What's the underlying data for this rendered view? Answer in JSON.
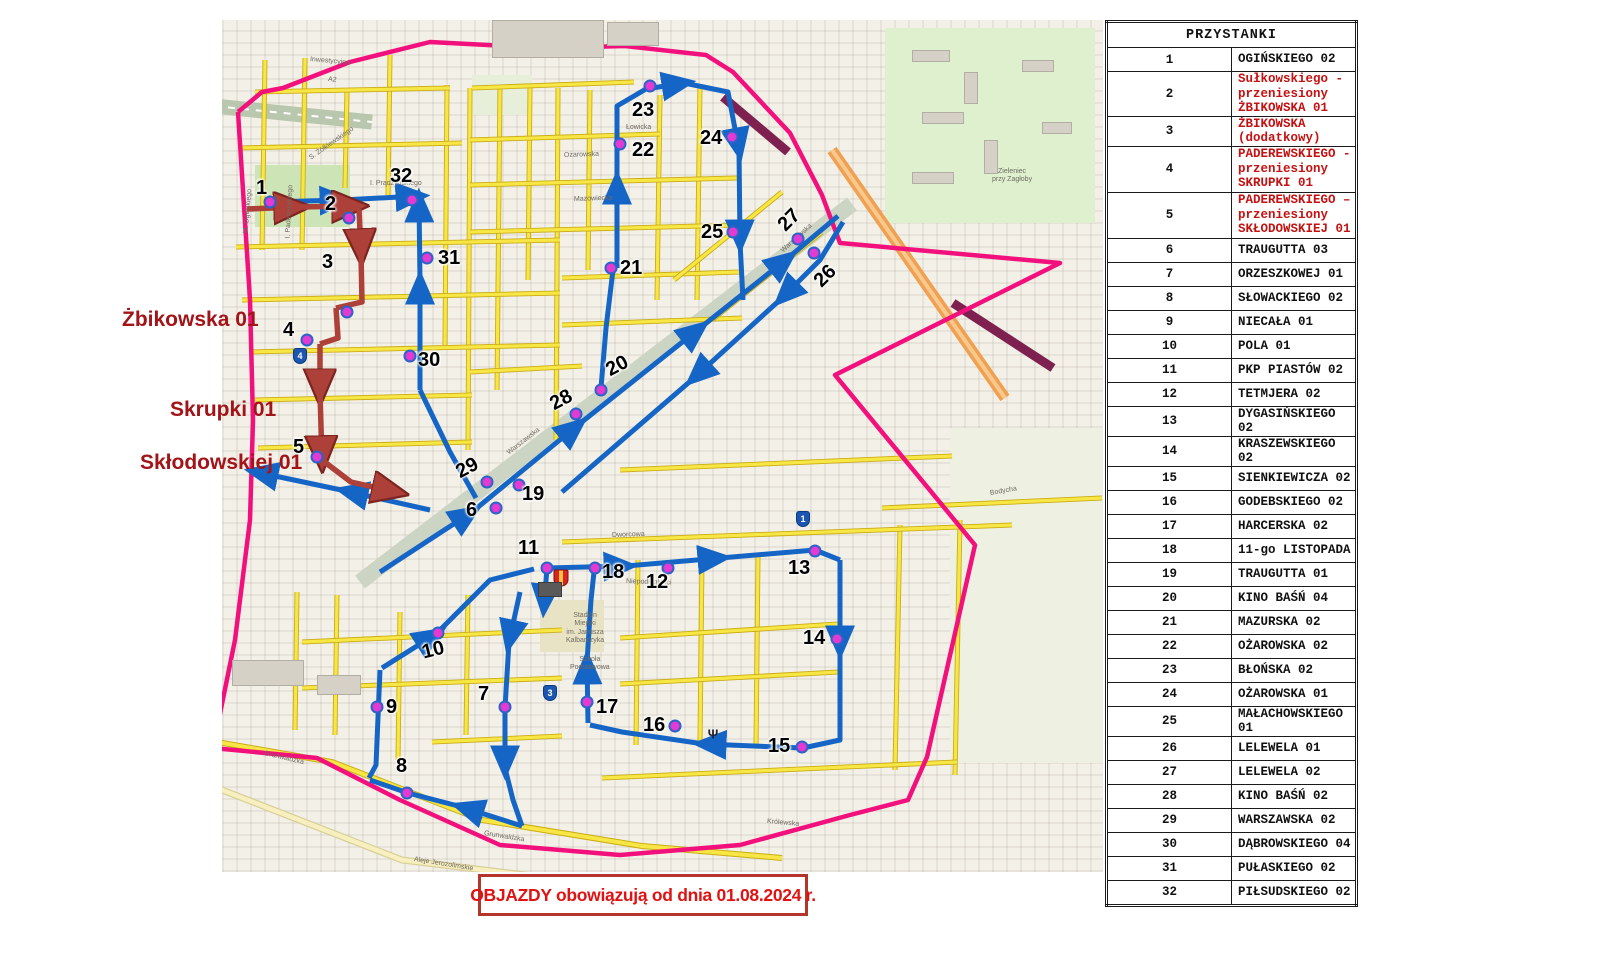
{
  "banner": {
    "text": "OBJAZDY obowiązują od dnia 01.08.2024 r."
  },
  "legend": {
    "items": [
      {
        "icon": "stop-dot-icon",
        "label": "- przystanki"
      },
      {
        "icon": "blue-route-arrow-icon",
        "label": "- trasa i kierunek jazdy"
      },
      {
        "icon": "detour-arrow-icon",
        "label": "- Objazd: zamknięcie",
        "label2": "ul. Ogińskiego"
      }
    ]
  },
  "left_labels": [
    {
      "text": "Żbikowska 01",
      "x": 122,
      "y": 308
    },
    {
      "text": "Skrupki 01",
      "x": 170,
      "y": 398
    },
    {
      "text": "Skłodowskiej 01",
      "x": 140,
      "y": 451
    }
  ],
  "table": {
    "header": "PRZYSTANKI",
    "rows": [
      {
        "no": 1,
        "lines": [
          "OGIŃSKIEGO 02"
        ],
        "red": false
      },
      {
        "no": 2,
        "lines": [
          "Sułkowskiego - przeniesiony",
          "ŻBIKOWSKA 01"
        ],
        "red": true
      },
      {
        "no": 3,
        "lines": [
          "ŻBIKOWSKA (dodatkowy)"
        ],
        "red": true
      },
      {
        "no": 4,
        "lines": [
          "PADEREWSKIEGO -",
          "przeniesiony",
          "SKRUPKI 01"
        ],
        "red": true
      },
      {
        "no": 5,
        "lines": [
          "PADEREWSKIEGO –",
          "przeniesiony",
          "SKŁODOWSKIEJ 01"
        ],
        "red": true
      },
      {
        "no": 6,
        "lines": [
          "TRAUGUTTA 03"
        ],
        "red": false
      },
      {
        "no": 7,
        "lines": [
          "ORZESZKOWEJ 01"
        ],
        "red": false
      },
      {
        "no": 8,
        "lines": [
          "SŁOWACKIEGO 02"
        ],
        "red": false
      },
      {
        "no": 9,
        "lines": [
          "NIECAŁA 01"
        ],
        "red": false
      },
      {
        "no": 10,
        "lines": [
          "POLA 01"
        ],
        "red": false
      },
      {
        "no": 11,
        "lines": [
          "PKP PIASTÓW 02"
        ],
        "red": false
      },
      {
        "no": 12,
        "lines": [
          "TETMJERA 02"
        ],
        "red": false
      },
      {
        "no": 13,
        "lines": [
          "DYGASIŃSKIEGO 02"
        ],
        "red": false
      },
      {
        "no": 14,
        "lines": [
          "KRASZEWSKIEGO 02"
        ],
        "red": false
      },
      {
        "no": 15,
        "lines": [
          "SIENKIEWICZA 02"
        ],
        "red": false
      },
      {
        "no": 16,
        "lines": [
          "GODEBSKIEGO 02"
        ],
        "red": false
      },
      {
        "no": 17,
        "lines": [
          "HARCERSKA 02"
        ],
        "red": false
      },
      {
        "no": 18,
        "lines": [
          "11-go LISTOPADA"
        ],
        "red": false
      },
      {
        "no": 19,
        "lines": [
          "TRAUGUTTA 01"
        ],
        "red": false
      },
      {
        "no": 20,
        "lines": [
          "KINO BAŚŃ  04"
        ],
        "red": false
      },
      {
        "no": 21,
        "lines": [
          "MAZURSKA 02"
        ],
        "red": false
      },
      {
        "no": 22,
        "lines": [
          "OŻAROWSKA 02"
        ],
        "red": false
      },
      {
        "no": 23,
        "lines": [
          "BŁOŃSKA 02"
        ],
        "red": false
      },
      {
        "no": 24,
        "lines": [
          "OŻAROWSKA 01"
        ],
        "red": false
      },
      {
        "no": 25,
        "lines": [
          "MAŁACHOWSKIEGO 01"
        ],
        "red": false
      },
      {
        "no": 26,
        "lines": [
          "LELEWELA  01"
        ],
        "red": false
      },
      {
        "no": 27,
        "lines": [
          "LELEWELA  02"
        ],
        "red": false
      },
      {
        "no": 28,
        "lines": [
          "KINO BAŚŃ 02"
        ],
        "red": false
      },
      {
        "no": 29,
        "lines": [
          "WARSZAWSKA 02"
        ],
        "red": false
      },
      {
        "no": 30,
        "lines": [
          "DĄBROWSKIEGO 04"
        ],
        "red": false
      },
      {
        "no": 31,
        "lines": [
          "PUŁASKIEGO 02"
        ],
        "red": false
      },
      {
        "no": 32,
        "lines": [
          "PIŁSUDSKIEGO 02"
        ],
        "red": false
      }
    ]
  },
  "map": {
    "stops": [
      {
        "no": "1",
        "dot": [
          48,
          182
        ],
        "label": [
          34,
          158
        ]
      },
      {
        "no": "2",
        "dot": [
          127,
          198
        ],
        "label": [
          103,
          174
        ]
      },
      {
        "no": "3",
        "dot": [
          125,
          292
        ],
        "label": [
          100,
          232
        ]
      },
      {
        "no": "4",
        "dot": [
          85,
          320
        ],
        "label": [
          61,
          300
        ]
      },
      {
        "no": "5",
        "dot": [
          95,
          437
        ],
        "label": [
          71,
          417
        ]
      },
      {
        "no": "6",
        "dot": [
          274,
          488
        ],
        "label": [
          244,
          480
        ]
      },
      {
        "no": "7",
        "dot": [
          283,
          687
        ],
        "label": [
          256,
          664
        ]
      },
      {
        "no": "8",
        "dot": [
          185,
          773
        ],
        "label": [
          174,
          736
        ]
      },
      {
        "no": "9",
        "dot": [
          155,
          687
        ],
        "label": [
          164,
          677
        ]
      },
      {
        "no": "10",
        "dot": [
          216,
          613
        ],
        "label": [
          200,
          620
        ],
        "rot": -14
      },
      {
        "no": "11",
        "dot": [
          325,
          548
        ],
        "label": [
          296,
          518
        ]
      },
      {
        "no": "12",
        "dot": [
          446,
          548
        ],
        "label": [
          424,
          552
        ]
      },
      {
        "no": "13",
        "dot": [
          593,
          531
        ],
        "label": [
          566,
          538
        ]
      },
      {
        "no": "14",
        "dot": [
          615,
          619
        ],
        "label": [
          581,
          608
        ]
      },
      {
        "no": "15",
        "dot": [
          580,
          727
        ],
        "label": [
          546,
          716
        ]
      },
      {
        "no": "16",
        "dot": [
          453,
          706
        ],
        "label": [
          421,
          695
        ]
      },
      {
        "no": "17",
        "dot": [
          365,
          682
        ],
        "label": [
          374,
          677
        ]
      },
      {
        "no": "18",
        "dot": [
          373,
          548
        ],
        "label": [
          380,
          542
        ]
      },
      {
        "no": "19",
        "dot": [
          297,
          465
        ],
        "label": [
          300,
          464
        ]
      },
      {
        "no": "20",
        "dot": [
          379,
          370
        ],
        "label": [
          384,
          336
        ],
        "rot": -28
      },
      {
        "no": "21",
        "dot": [
          389,
          248
        ],
        "label": [
          398,
          238
        ]
      },
      {
        "no": "22",
        "dot": [
          398,
          124
        ],
        "label": [
          410,
          120
        ]
      },
      {
        "no": "23",
        "dot": [
          428,
          66
        ],
        "label": [
          410,
          80
        ]
      },
      {
        "no": "24",
        "dot": [
          510,
          117
        ],
        "label": [
          478,
          108
        ]
      },
      {
        "no": "25",
        "dot": [
          511,
          212
        ],
        "label": [
          479,
          202
        ]
      },
      {
        "no": "26",
        "dot": [
          592,
          233
        ],
        "label": [
          592,
          246
        ],
        "rot": -45
      },
      {
        "no": "27",
        "dot": [
          576,
          219
        ],
        "label": [
          556,
          190
        ],
        "rot": -45
      },
      {
        "no": "28",
        "dot": [
          354,
          394
        ],
        "label": [
          328,
          370
        ],
        "rot": -28
      },
      {
        "no": "29",
        "dot": [
          265,
          462
        ],
        "label": [
          234,
          438
        ],
        "rot": -28
      },
      {
        "no": "30",
        "dot": [
          188,
          336
        ],
        "label": [
          196,
          330
        ]
      },
      {
        "no": "31",
        "dot": [
          205,
          238
        ],
        "label": [
          216,
          228
        ]
      },
      {
        "no": "32",
        "dot": [
          190,
          180
        ],
        "label": [
          168,
          146
        ]
      }
    ],
    "street_labels": [
      {
        "t": "A2",
        "x": 106,
        "y": 56,
        "r": 6
      },
      {
        "t": "Inwestycyjna",
        "x": 88,
        "y": 36,
        "r": 5
      },
      {
        "t": "M. Ogińskiego",
        "x": 24,
        "y": 210,
        "r": -85
      },
      {
        "t": "I. Paderewskiego",
        "x": 66,
        "y": 215,
        "r": -87
      },
      {
        "t": "S. Żółkiewskiego",
        "x": 88,
        "y": 135,
        "r": -35
      },
      {
        "t": "I. Prądzyńskiego",
        "x": 148,
        "y": 160,
        "r": 0
      },
      {
        "t": "Łowicka",
        "x": 404,
        "y": 104,
        "r": 0
      },
      {
        "t": "Ożarowska",
        "x": 342,
        "y": 132,
        "r": -2
      },
      {
        "t": "Mazowiecka",
        "x": 352,
        "y": 176,
        "r": -2
      },
      {
        "t": "Warszawska",
        "x": 560,
        "y": 228,
        "r": -42
      },
      {
        "t": "Warszawska",
        "x": 286,
        "y": 430,
        "r": -38
      },
      {
        "t": "Dworcowa",
        "x": 390,
        "y": 512,
        "r": -2
      },
      {
        "t": "Niepodległości",
        "x": 404,
        "y": 558,
        "r": 2
      },
      {
        "t": "Grunwaldzka",
        "x": 42,
        "y": 730,
        "r": 13
      },
      {
        "t": "Grunwaldzka",
        "x": 262,
        "y": 810,
        "r": 9
      },
      {
        "t": "Królewska",
        "x": 545,
        "y": 798,
        "r": 5
      },
      {
        "t": "Aleje Jerozolimskie",
        "x": 192,
        "y": 836,
        "r": 9
      },
      {
        "t": "Bodycha",
        "x": 768,
        "y": 470,
        "r": -10
      }
    ],
    "poi_labels": [
      {
        "t": "Panattoni\nPark Konotopa",
        "x": 386,
        "y": 6
      },
      {
        "t": "Stadion\nMiejski\nim. Janusza\nKalbarczyka",
        "x": 344,
        "y": 592
      },
      {
        "t": "Zieleniec\nprzy Zagłoby",
        "x": 770,
        "y": 148
      },
      {
        "t": "Szkoła\nPodstawowa",
        "x": 348,
        "y": 636
      }
    ],
    "road_shields": [
      {
        "n": "4",
        "x": 78,
        "y": 336
      },
      {
        "n": "1",
        "x": 581,
        "y": 499
      },
      {
        "n": "3",
        "x": 328,
        "y": 673
      }
    ],
    "map_symbols": [
      {
        "t": "Ψ",
        "x": 491,
        "y": 714
      }
    ],
    "colors": {
      "boundary_pink": "#f2117c",
      "route_blue": "#1565c6",
      "detour_red": "#ad4038",
      "stop_dot_fill": "#e23ad2",
      "stop_dot_ring": "#2c63c8",
      "road_yellow": "#f8e645",
      "road_casing": "#c9ad18",
      "closed_road_maroon": "#7e2150",
      "motorway_orange": "#f0a050",
      "red_text": "#c41111"
    }
  }
}
